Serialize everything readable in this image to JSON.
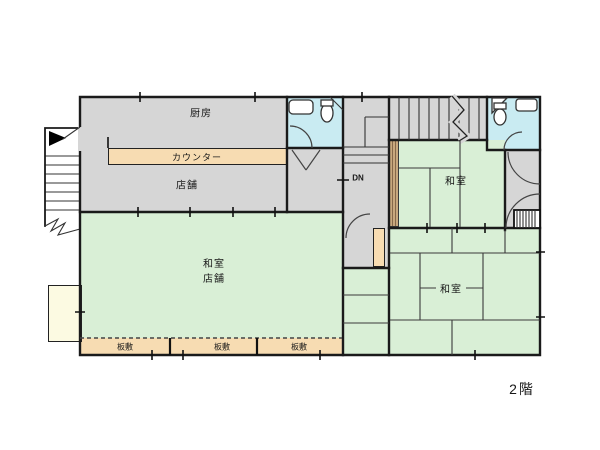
{
  "floor_label": "2階",
  "labels": {
    "kitchen": "厨房",
    "counter": "カウンター",
    "shop": "店舗",
    "washitsu_top_right": "和室",
    "washitsu_shop_line1": "和室",
    "washitsu_shop_line2": "店舗",
    "washitsu_bottom_right": "和室",
    "itajiki_1": "板敷",
    "itajiki_2": "板敷",
    "itajiki_3": "板敷",
    "stairs_down": "DN"
  },
  "colors": {
    "room-gray": "#d6d6d6",
    "room-green": "#d9efd6",
    "bath-cyan": "#c9ebf2",
    "wood-tan": "#f7dcb2",
    "plank-brown": "#c9a87e",
    "annex-cream": "#fcfae2",
    "wall": "#1a1a1a"
  }
}
